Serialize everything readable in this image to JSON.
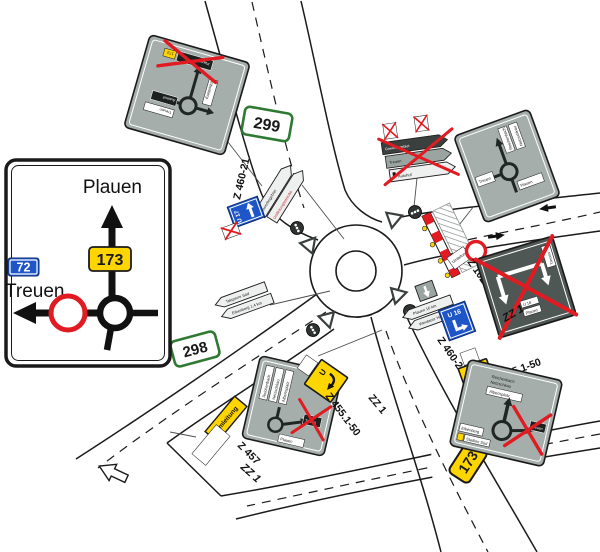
{
  "main_sign": {
    "top_destination": "Plauen",
    "left_destination": "Treuen",
    "route_blue": "72",
    "route_yellow": "173"
  },
  "shields": {
    "north": "299",
    "southwest": "298",
    "southeast": "173"
  },
  "detour_signs": {
    "u17": "U 17",
    "u16": "U 16",
    "u_hook": "U",
    "umleitung": "Umleitung",
    "barrier_note": "Umleitung"
  },
  "labels": {
    "z460_north": "Z 460-21",
    "z460_mid": "Z 460-21",
    "z1028": "Z 1028-30",
    "z455_right": "Z 455.1-50",
    "z455_mid": "Z 455.1-50",
    "z457": "Z 457",
    "zz1_right": "ZZ 1",
    "zz1_mid": "ZZ 1",
    "zz1_left": "ZZ 1"
  },
  "pointers": {
    "nw_gray": "Gewerbegebiet",
    "nw_white": "Umleitungsstrecke",
    "ne_dark": "Gewerbegebiet",
    "ne_gray": "Treuen",
    "ne_white": "Autohof",
    "e_top": "Plauen 16 km",
    "e_bottom": "Werdauer Höhe",
    "w_top": "Talsperre Süd",
    "w_bottom": "Eibenberg 1,4 km"
  },
  "map_signs": {
    "top_left": {
      "box_right_top": "Treuen",
      "box_right_mid": "Autohof",
      "box_left": "Eibenberg",
      "box_bottom": "Plauen",
      "shield": "173"
    },
    "right": {
      "box_v1": "Reichenbach",
      "box_v2": "Netzschkau",
      "box_left": "Treuen",
      "box_bottom": "Plauen"
    },
    "bottom_middle": {
      "strip1": "Reichenbach",
      "strip2": "Netzschkau",
      "strip3": "Albertsplatz",
      "box_black": "Treuen",
      "box_bottom": "Plauen"
    },
    "bottom_right": {
      "line1": "Reichenbach",
      "line2": "Netzschkau",
      "box_top": "Albertsplatz",
      "box_black": "Treuen",
      "box_left": "Eibenberg",
      "box_left2": "Stadion Süd"
    }
  },
  "lane_sign_right": {
    "box_v": "Treuen",
    "box_1": "U 16",
    "box_2": "Plauen"
  },
  "colors": {
    "sign_gray": "#a5aeab",
    "sign_dark": "#4f5754",
    "cross_red": "#e01b22",
    "detour_yellow": "#ffd500",
    "route_blue": "#1e56c8",
    "route_green_border": "#2f7a33"
  }
}
